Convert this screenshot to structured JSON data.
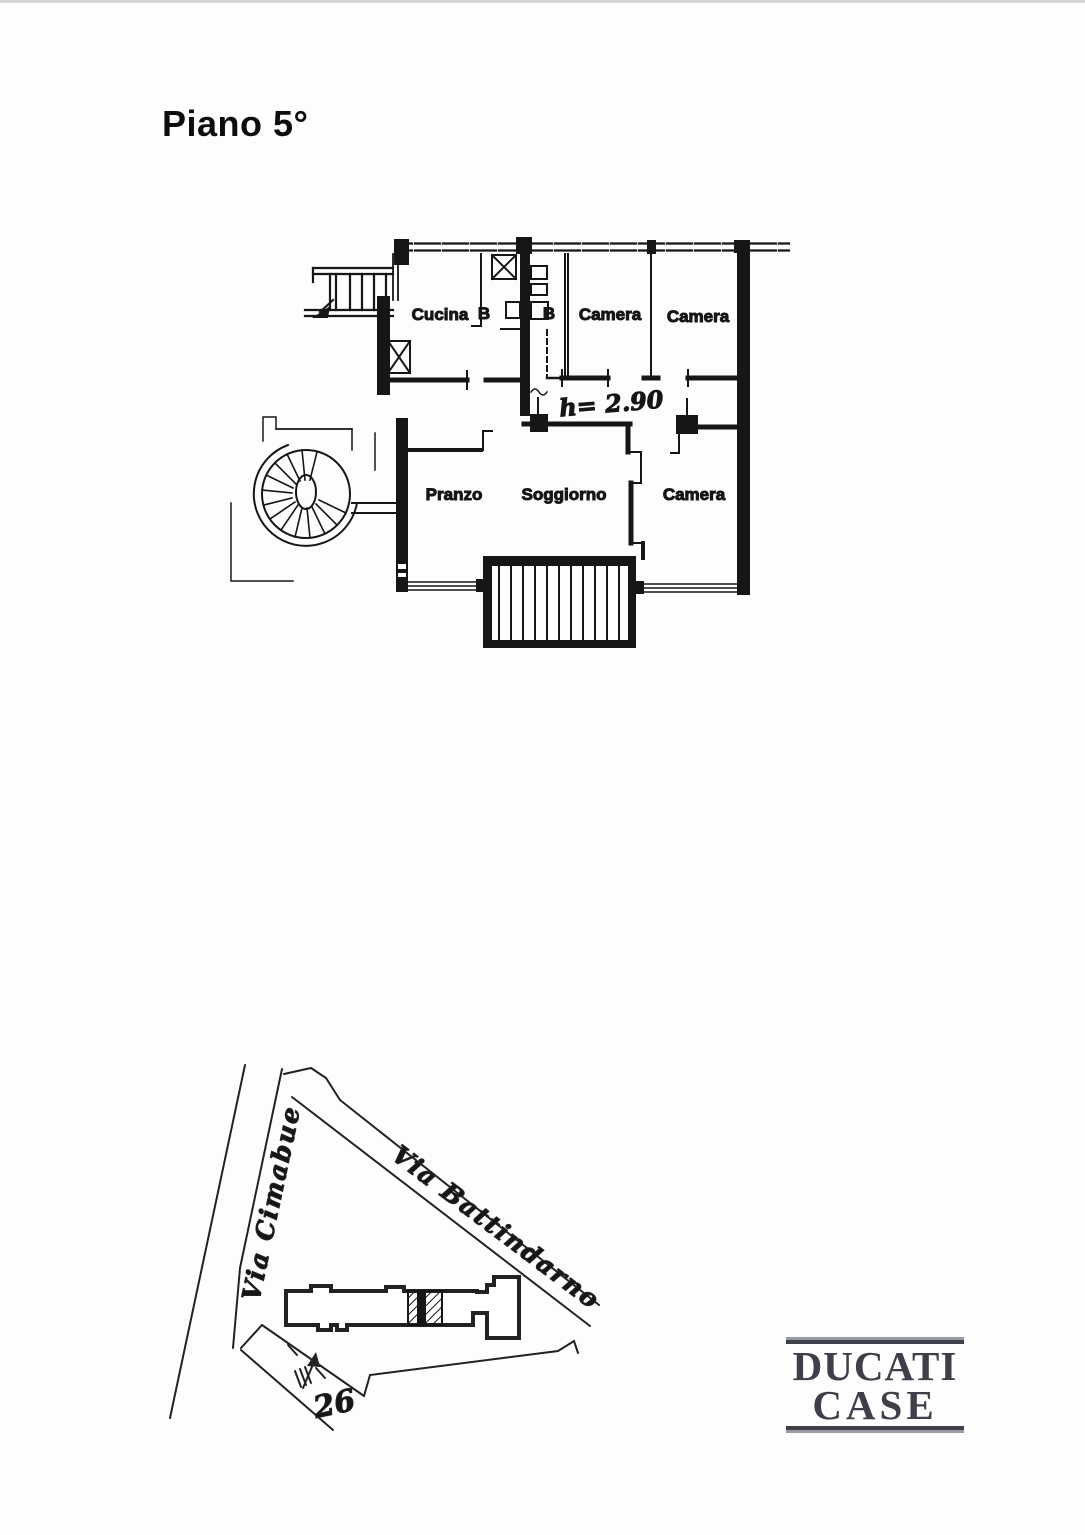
{
  "page": {
    "title": "Piano 5°"
  },
  "floorplan": {
    "height_note": "h= 2.90",
    "rooms": [
      {
        "label": "Cucina"
      },
      {
        "label": "B"
      },
      {
        "label": "B"
      },
      {
        "label": "Camera"
      },
      {
        "label": "Camera"
      },
      {
        "label": "Pranzo"
      },
      {
        "label": "Soggiorno"
      },
      {
        "label": "Camera"
      }
    ]
  },
  "siteplan": {
    "streets": [
      {
        "label": "Via Cimabue"
      },
      {
        "label": "Via Battindarno"
      }
    ],
    "civic_number": "26"
  },
  "logo": {
    "line1": "DUCATI",
    "line2": "CASE"
  },
  "colors": {
    "ink": "#161616",
    "logo": "#3e3f49"
  }
}
